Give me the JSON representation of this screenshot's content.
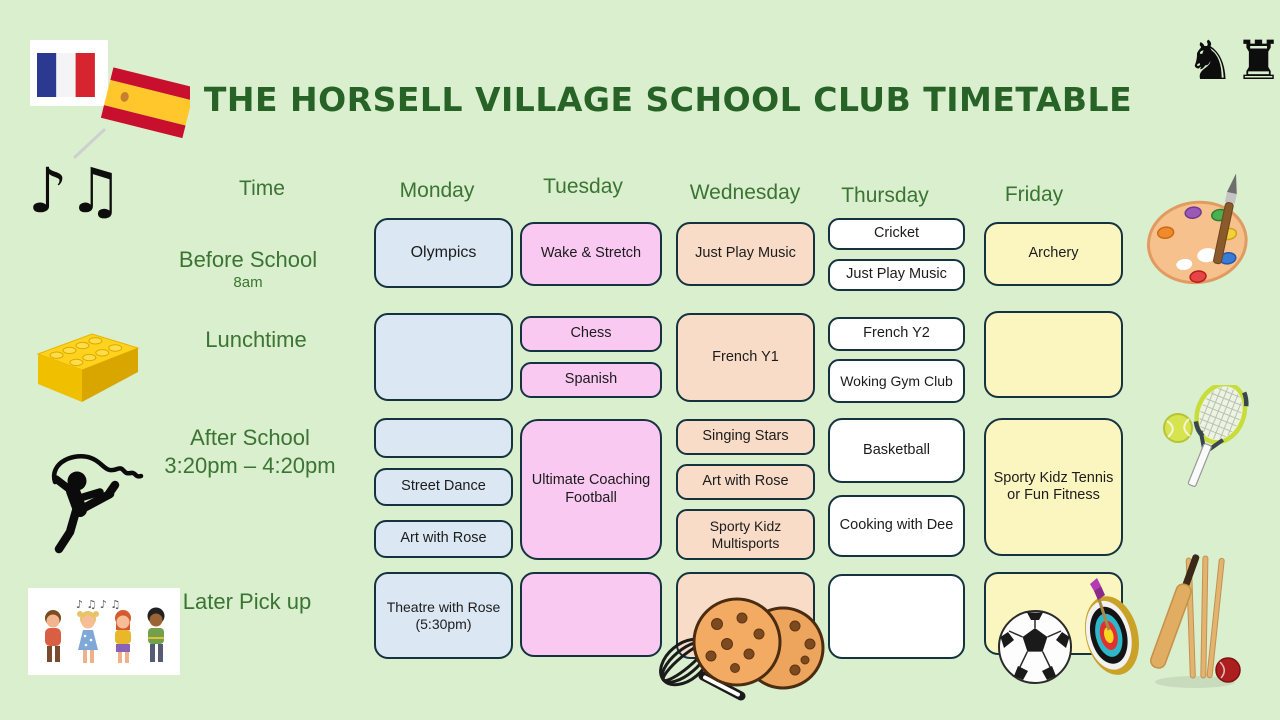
{
  "title": "THE HORSELL VILLAGE SCHOOL CLUB TIMETABLE",
  "header": {
    "time": "Time",
    "days": [
      "Monday",
      "Tuesday",
      "Wednesday",
      "Thursday",
      "Friday"
    ]
  },
  "rows": [
    {
      "label": "Before School",
      "sublabel": "8am",
      "monday": [
        "Olympics"
      ],
      "tuesday": [
        "Wake & Stretch"
      ],
      "wednesday": [
        "Just Play Music"
      ],
      "thursday": [
        "Cricket",
        "Just Play Music"
      ],
      "friday": [
        "Archery"
      ]
    },
    {
      "label": "Lunchtime",
      "sublabel": "",
      "monday": [
        ""
      ],
      "tuesday": [
        "Chess",
        "Spanish"
      ],
      "wednesday": [
        "French Y1"
      ],
      "thursday": [
        "French Y2",
        "Woking Gym Club"
      ],
      "friday": [
        ""
      ]
    },
    {
      "label": "After School",
      "sublabel": "3:20pm – 4:20pm",
      "monday": [
        "",
        "Street Dance",
        "Art with Rose"
      ],
      "tuesday": [
        "Ultimate Coaching Football"
      ],
      "wednesday": [
        "Singing Stars",
        "Art with Rose",
        "Sporty Kidz Multisports"
      ],
      "thursday": [
        "Basketball",
        "Cooking with Dee"
      ],
      "friday": [
        "Sporty Kidz Tennis or Fun Fitness"
      ]
    },
    {
      "label": "Later Pick up",
      "sublabel": "",
      "monday": [
        "Theatre with Rose (5:30pm)"
      ],
      "tuesday": [
        ""
      ],
      "wednesday": [
        ""
      ],
      "thursday": [
        ""
      ],
      "friday": [
        ""
      ]
    }
  ],
  "icons": {
    "chess_pieces": "♞♜",
    "music_notes": "♪♫",
    "decoration_names": [
      "french-flag",
      "spanish-flag",
      "chess-pieces",
      "music-notes",
      "lego-brick",
      "ribbon-dancer",
      "singing-kids",
      "paint-palette",
      "tennis-racket-and-ball",
      "soccer-ball",
      "archery-target",
      "cricket-set",
      "cookies-and-whisk"
    ]
  },
  "colors": {
    "background": "#d9efce",
    "title_green": "#276227",
    "label_green": "#3c7434",
    "box_border": "#15333f",
    "monday_fill": "#dbe7f2",
    "tuesday_fill": "#f9c9f2",
    "wednesday_fill": "#f8dcc7",
    "thursday_fill": "#ffffff",
    "friday_fill": "#fbf6c0"
  }
}
